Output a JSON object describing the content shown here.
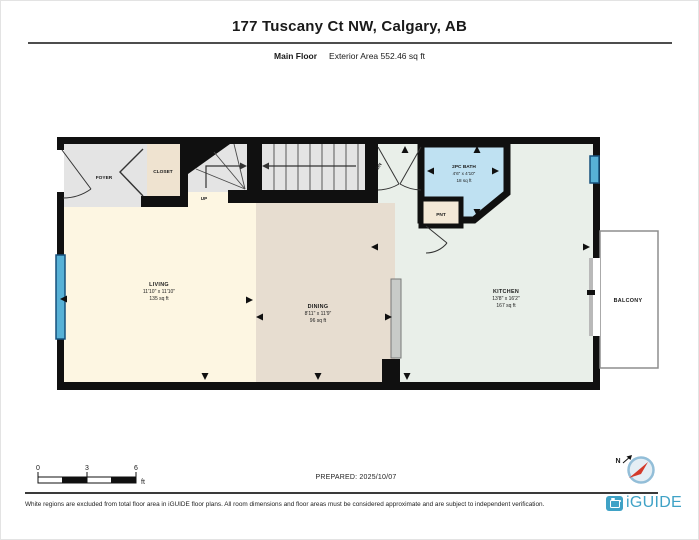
{
  "header": {
    "title": "177 Tuscany Ct NW, Calgary, AB",
    "floor_label": "Main Floor",
    "area_label": "Exterior Area 552.46 sq ft"
  },
  "rooms": {
    "foyer": {
      "name": "FOYER"
    },
    "closet": {
      "name": "CLOSET"
    },
    "living": {
      "name": "LIVING",
      "dims": "11'10\" x 11'10\"",
      "area": "135 sq ft"
    },
    "dining": {
      "name": "DINING",
      "dims": "8'11\" x 11'9\"",
      "area": "96 sq ft"
    },
    "kitchen": {
      "name": "KITCHEN",
      "dims": "13'8\" x 16'2\"",
      "area": "167 sq ft"
    },
    "bath": {
      "name": "2PC BATH",
      "dims": "4'6\" x 4'10\"",
      "area": "18 sq ft"
    },
    "pantry": {
      "name": "PNT"
    },
    "balcony": {
      "name": "BALCONY"
    }
  },
  "stairs": {
    "up_label": "UP",
    "down_label": "DN"
  },
  "scale_bar": {
    "start": "0",
    "mid": "3",
    "end": "6",
    "unit": "ft"
  },
  "compass": {
    "north_label": "N"
  },
  "footer": {
    "prepared": "PREPARED: 2025/10/07",
    "disclaimer": "White regions are excluded from total floor area in iGUIDE floor plans. All room dimensions and floor areas must be considered approximate and are subject to independent verification.",
    "brand": "iGUIDE"
  },
  "colors": {
    "wall": "#101010",
    "living_fill": "#fdf6e2",
    "dining_fill": "#e7ddd0",
    "kitchen_fill": "#e9efe9",
    "foyer_fill": "#e4e4e4",
    "closet_fill": "#efe3d0",
    "bath_fill": "#bfe1f2",
    "pantry_fill": "#f3e8d6",
    "window": "#57b1d6",
    "brand_blue": "#3fa2c6",
    "compass_needle": "#d43a2a"
  }
}
